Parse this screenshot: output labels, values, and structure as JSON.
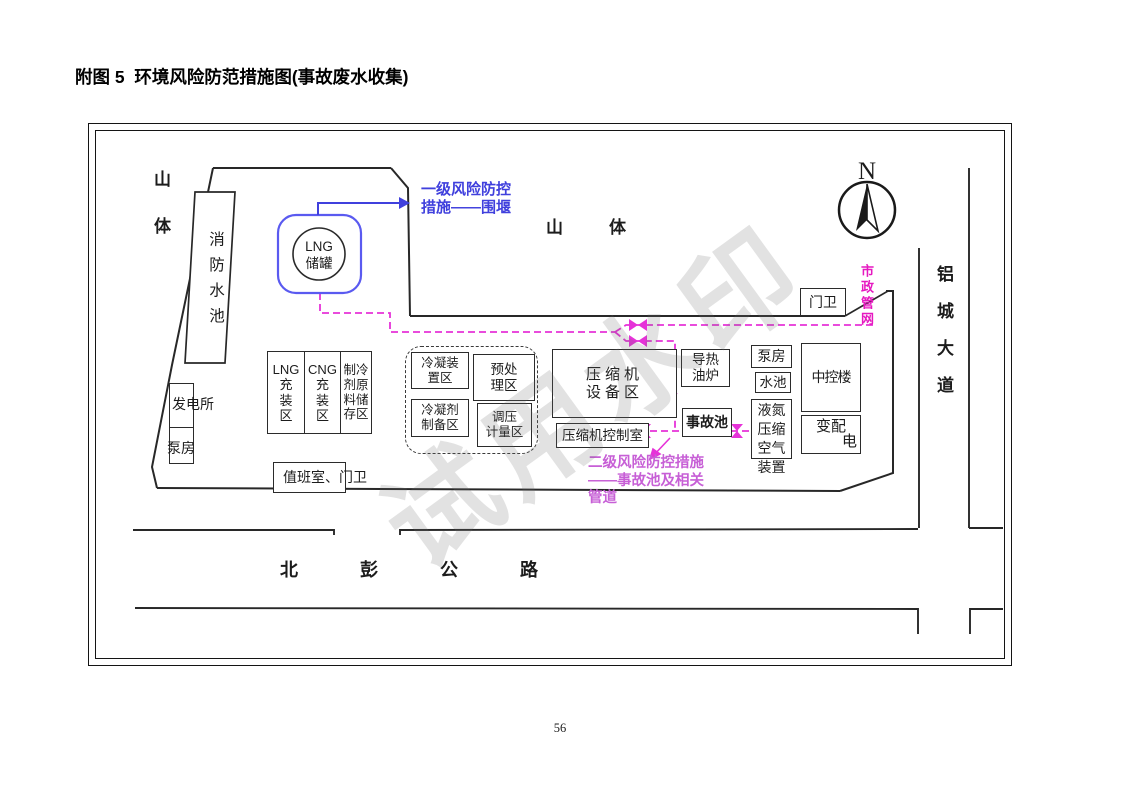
{
  "page": {
    "title": "附图 5  环境风险防范措施图(事故废水收集)",
    "page_number": "56",
    "watermark": "试用水印"
  },
  "compass": {
    "label": "N"
  },
  "terrain": {
    "mountain_left": "山体",
    "mountain_top": "山体",
    "fire_water_pool": "消防水池"
  },
  "roads": {
    "south": "北彭公路",
    "east": "铝城大道"
  },
  "tank": {
    "label": "LNG\n储罐"
  },
  "buildings": {
    "gate_top": "门卫",
    "power_station": "发电所",
    "pump_left": "泵房",
    "lng_filling": "LNG\n充\n装\n区",
    "cng_filling": "CNG\n充\n装\n区",
    "refrigerant_storage": "制冷\n剂原\n料储\n存区",
    "duty_room": "值班室、门卫",
    "condensing_unit": "冷凝装\n置区",
    "pretreatment": "预处\n理区",
    "condensing_agent": "冷凝剂\n制备区",
    "regulating_metering": "调压\n计量区",
    "compressor_equipment": "压缩机\n设备区",
    "compressor_control": "压缩机控制室",
    "heat_oil_furnace": "导热\n油炉",
    "accident_pool": "事故池",
    "pump_right": "泵房",
    "water_pool": "水池",
    "nitrogen_unit": "液氮\n压缩\n空气\n装置",
    "central_control": "中控楼",
    "transformer_line1": "变配",
    "transformer_line2": "电"
  },
  "annotations": {
    "primary": "一级风险防控\n措施——围堰",
    "secondary": "二级风险防控措施\n——事故池及相关\n管道",
    "municipal": "市政管网"
  },
  "colors": {
    "line": "#282828",
    "pipeline": "#e632d8",
    "tank": "#5a5af0",
    "primary": "#4040dd",
    "secondary": "#c75fd6",
    "municipal": "#e619c0"
  }
}
